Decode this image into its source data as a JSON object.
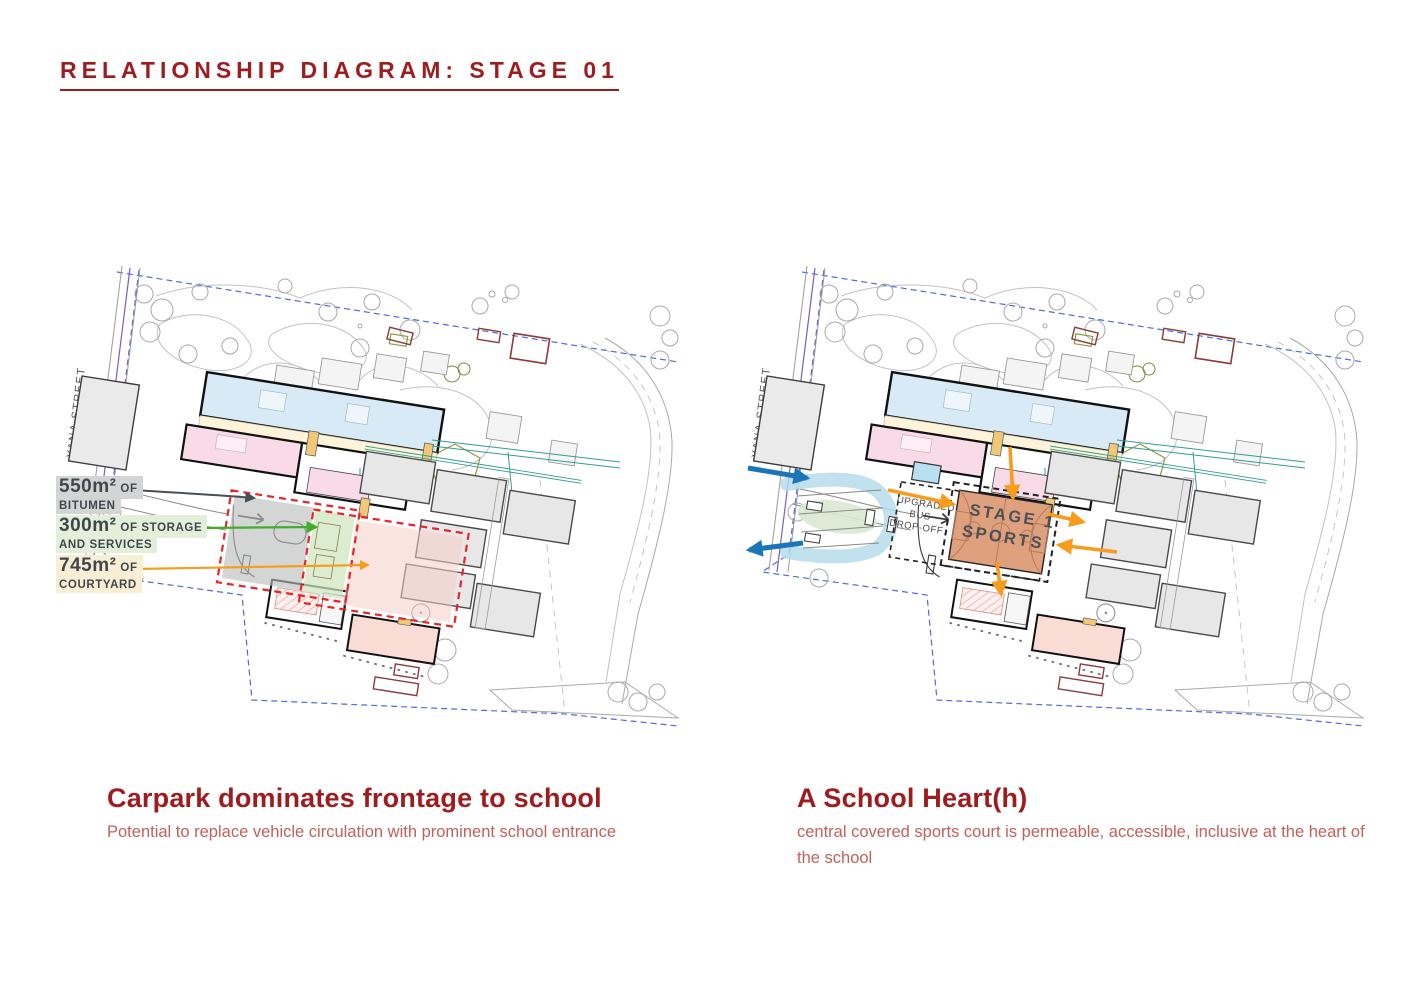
{
  "title": "RELATIONSHIP DIAGRAM: STAGE 01",
  "shared": {
    "street_label": "YANA STREET"
  },
  "left": {
    "annotations": [
      {
        "amount": "550m²",
        "amount_suffix": "OF",
        "line2": "BITUMEN"
      },
      {
        "amount": "300m²",
        "amount_suffix": "OF STORAGE",
        "line2": "AND SERVICES"
      },
      {
        "amount": "745m²",
        "amount_suffix": "OF",
        "line2": "COURTYARD"
      }
    ],
    "caption": {
      "title": "Carpark dominates frontage to school",
      "subtitle": "Potential to replace vehicle circulation with prominent school entrance"
    }
  },
  "right": {
    "court": {
      "line1": "STAGE 1",
      "line2": "SPORTS"
    },
    "bus": {
      "line1": "UPGRADED",
      "line2": "BUS",
      "line3": "DROP-OFF"
    },
    "caption": {
      "title": "A School Heart(h)",
      "subtitle": "central covered sports court is permeable, accessible, inclusive at the heart of the school"
    }
  },
  "colors": {
    "title_red": "#9e1b1e",
    "subtitle_red": "#c2605c",
    "arrow_dark": "#494f54",
    "arrow_green": "#3fae2a",
    "arrow_orange": "#f89c1c",
    "arrow_blue": "#1b75bb",
    "zone_red_dash": "#ea2328",
    "zone_gray": "#b9bcbc",
    "zone_green": "#cfe5bd",
    "zone_pink": "#f6cdc5",
    "court_fill": "#dfa07e",
    "court_lines": "#b97b5a",
    "bus_loop_blue": "#b5dcea",
    "median_green": "#d9e9d2",
    "boundary_blue": "#4f6bd8",
    "label_text": "#41474d"
  }
}
